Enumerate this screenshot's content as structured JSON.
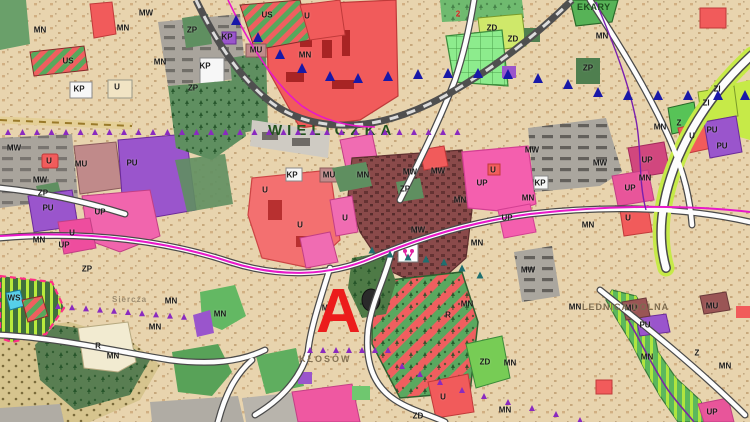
{
  "map": {
    "background_color": "#e8d4ae",
    "palette": {
      "zone_red_u": "#f15b5b",
      "zone_pink_up": "#f45fae",
      "zone_purple_pu": "#9a55cc",
      "zone_green_zp": "#5f8f60",
      "zone_bright_green_zd": "#7dd06f",
      "zone_lime_zi": "#c6ea48",
      "zone_gray_mw": "#a9a49c",
      "zone_maroon_oldtown": "#8a4a4a",
      "zone_beige_mn": "#e8d4ae",
      "stripe_red": "#ef5f5f",
      "stripe_green": "#57a85c",
      "railway_gray": "#4f4f4f",
      "boundary_magenta": "#e818c8",
      "boundary_purple": "#7a1fae",
      "marker_blue": "#1818a8",
      "marker_violet": "#8a2abf",
      "marker_teal": "#1f6f6f",
      "road_white": "#fdfdfd",
      "landslide_border_pink": "#ff2f86",
      "water_cyan": "#56cfe8"
    },
    "marker_a": {
      "text": "A",
      "x": 316,
      "y": 284,
      "size": 62,
      "color": "#ec1c1c"
    },
    "place_names": [
      {
        "text": "WIELICZKA",
        "x": 268,
        "y": 120,
        "size": 15,
        "ls": 5,
        "color": "#23521f"
      },
      {
        "text": "KŁOSÓW",
        "x": 299,
        "y": 354,
        "size": 9,
        "ls": 2,
        "color": "#857354"
      },
      {
        "text": "LEDNICA DOLNA",
        "x": 582,
        "y": 302,
        "size": 9,
        "ls": 1,
        "color": "#7d6c50"
      },
      {
        "text": "Siercza",
        "x": 112,
        "y": 295,
        "size": 8,
        "ls": 1,
        "color": "#9c8c70"
      },
      {
        "text": "EKARY",
        "x": 577,
        "y": 2,
        "size": 9,
        "ls": 0.5,
        "color": "#1d4d1d"
      }
    ],
    "zone_labels": [
      {
        "t": "MN",
        "x": 123,
        "y": 28
      },
      {
        "t": "MN",
        "x": 40,
        "y": 30
      },
      {
        "t": "MN",
        "x": 160,
        "y": 62
      },
      {
        "t": "MN",
        "x": 305,
        "y": 55
      },
      {
        "t": "MN",
        "x": 602,
        "y": 36
      },
      {
        "t": "MN",
        "x": 660,
        "y": 127
      },
      {
        "t": "MN",
        "x": 645,
        "y": 178
      },
      {
        "t": "MN",
        "x": 528,
        "y": 198
      },
      {
        "t": "MN",
        "x": 588,
        "y": 225
      },
      {
        "t": "MN",
        "x": 477,
        "y": 243
      },
      {
        "t": "MN",
        "x": 467,
        "y": 304
      },
      {
        "t": "MN",
        "x": 575,
        "y": 307
      },
      {
        "t": "MN",
        "x": 647,
        "y": 357
      },
      {
        "t": "MN",
        "x": 725,
        "y": 366
      },
      {
        "t": "MN",
        "x": 510,
        "y": 363
      },
      {
        "t": "MN",
        "x": 505,
        "y": 410
      },
      {
        "t": "MN",
        "x": 328,
        "y": 308
      },
      {
        "t": "MN",
        "x": 113,
        "y": 356
      },
      {
        "t": "MN",
        "x": 155,
        "y": 327
      },
      {
        "t": "MN",
        "x": 171,
        "y": 301
      },
      {
        "t": "MN",
        "x": 220,
        "y": 314
      },
      {
        "t": "MN",
        "x": 363,
        "y": 175
      },
      {
        "t": "MN",
        "x": 460,
        "y": 200
      },
      {
        "t": "MN",
        "x": 39,
        "y": 240
      },
      {
        "t": "MW",
        "x": 146,
        "y": 13
      },
      {
        "t": "MW",
        "x": 14,
        "y": 148
      },
      {
        "t": "MW",
        "x": 40,
        "y": 180
      },
      {
        "t": "MW",
        "x": 410,
        "y": 172
      },
      {
        "t": "MW",
        "x": 438,
        "y": 171
      },
      {
        "t": "MW",
        "x": 418,
        "y": 230
      },
      {
        "t": "MW",
        "x": 532,
        "y": 150
      },
      {
        "t": "MW",
        "x": 600,
        "y": 163
      },
      {
        "t": "MW",
        "x": 528,
        "y": 270
      },
      {
        "t": "U",
        "x": 307,
        "y": 16
      },
      {
        "t": "U",
        "x": 117,
        "y": 87
      },
      {
        "t": "U",
        "x": 49,
        "y": 161
      },
      {
        "t": "U",
        "x": 72,
        "y": 233
      },
      {
        "t": "U",
        "x": 692,
        "y": 136
      },
      {
        "t": "U",
        "x": 628,
        "y": 218
      },
      {
        "t": "U",
        "x": 493,
        "y": 170
      },
      {
        "t": "U",
        "x": 443,
        "y": 397
      },
      {
        "t": "U",
        "x": 265,
        "y": 190
      },
      {
        "t": "U",
        "x": 300,
        "y": 225
      },
      {
        "t": "U",
        "x": 345,
        "y": 218
      },
      {
        "t": "UP",
        "x": 100,
        "y": 212
      },
      {
        "t": "UP",
        "x": 64,
        "y": 245
      },
      {
        "t": "UP",
        "x": 482,
        "y": 183
      },
      {
        "t": "UP",
        "x": 507,
        "y": 218
      },
      {
        "t": "UP",
        "x": 647,
        "y": 160
      },
      {
        "t": "UP",
        "x": 630,
        "y": 188
      },
      {
        "t": "UP",
        "x": 712,
        "y": 412
      },
      {
        "t": "PU",
        "x": 132,
        "y": 163
      },
      {
        "t": "PU",
        "x": 48,
        "y": 208
      },
      {
        "t": "PU",
        "x": 712,
        "y": 130
      },
      {
        "t": "PU",
        "x": 722,
        "y": 146
      },
      {
        "t": "PU",
        "x": 645,
        "y": 325
      },
      {
        "t": "MU",
        "x": 81,
        "y": 164
      },
      {
        "t": "MU",
        "x": 329,
        "y": 175
      },
      {
        "t": "MU",
        "x": 631,
        "y": 308
      },
      {
        "t": "MU",
        "x": 712,
        "y": 306
      },
      {
        "t": "MU",
        "x": 256,
        "y": 50
      },
      {
        "t": "ZP",
        "x": 192,
        "y": 30
      },
      {
        "t": "ZP",
        "x": 193,
        "y": 88
      },
      {
        "t": "ZP",
        "x": 405,
        "y": 189
      },
      {
        "t": "ZP",
        "x": 588,
        "y": 68
      },
      {
        "t": "ZP",
        "x": 43,
        "y": 193
      },
      {
        "t": "ZP",
        "x": 87,
        "y": 269
      },
      {
        "t": "ZD",
        "x": 492,
        "y": 28
      },
      {
        "t": "ZD",
        "x": 513,
        "y": 39
      },
      {
        "t": "ZD",
        "x": 485,
        "y": 362
      },
      {
        "t": "ZD",
        "x": 418,
        "y": 416
      },
      {
        "t": "ZI",
        "x": 717,
        "y": 89
      },
      {
        "t": "ZI",
        "x": 706,
        "y": 103
      },
      {
        "t": "Z",
        "x": 679,
        "y": 123
      },
      {
        "t": "Z",
        "x": 697,
        "y": 353
      },
      {
        "t": "US",
        "x": 267,
        "y": 15
      },
      {
        "t": "US",
        "x": 68,
        "y": 61
      },
      {
        "t": "KP",
        "x": 205,
        "y": 66
      },
      {
        "t": "KP",
        "x": 79,
        "y": 89
      },
      {
        "t": "KP",
        "x": 227,
        "y": 37
      },
      {
        "t": "KP",
        "x": 540,
        "y": 183
      },
      {
        "t": "KP",
        "x": 292,
        "y": 175
      },
      {
        "t": "R",
        "x": 98,
        "y": 346
      },
      {
        "t": "R",
        "x": 448,
        "y": 315
      },
      {
        "t": "WS",
        "x": 14,
        "y": 298
      },
      {
        "t": "2",
        "x": 458,
        "y": 14,
        "c": "#e02020"
      }
    ]
  }
}
